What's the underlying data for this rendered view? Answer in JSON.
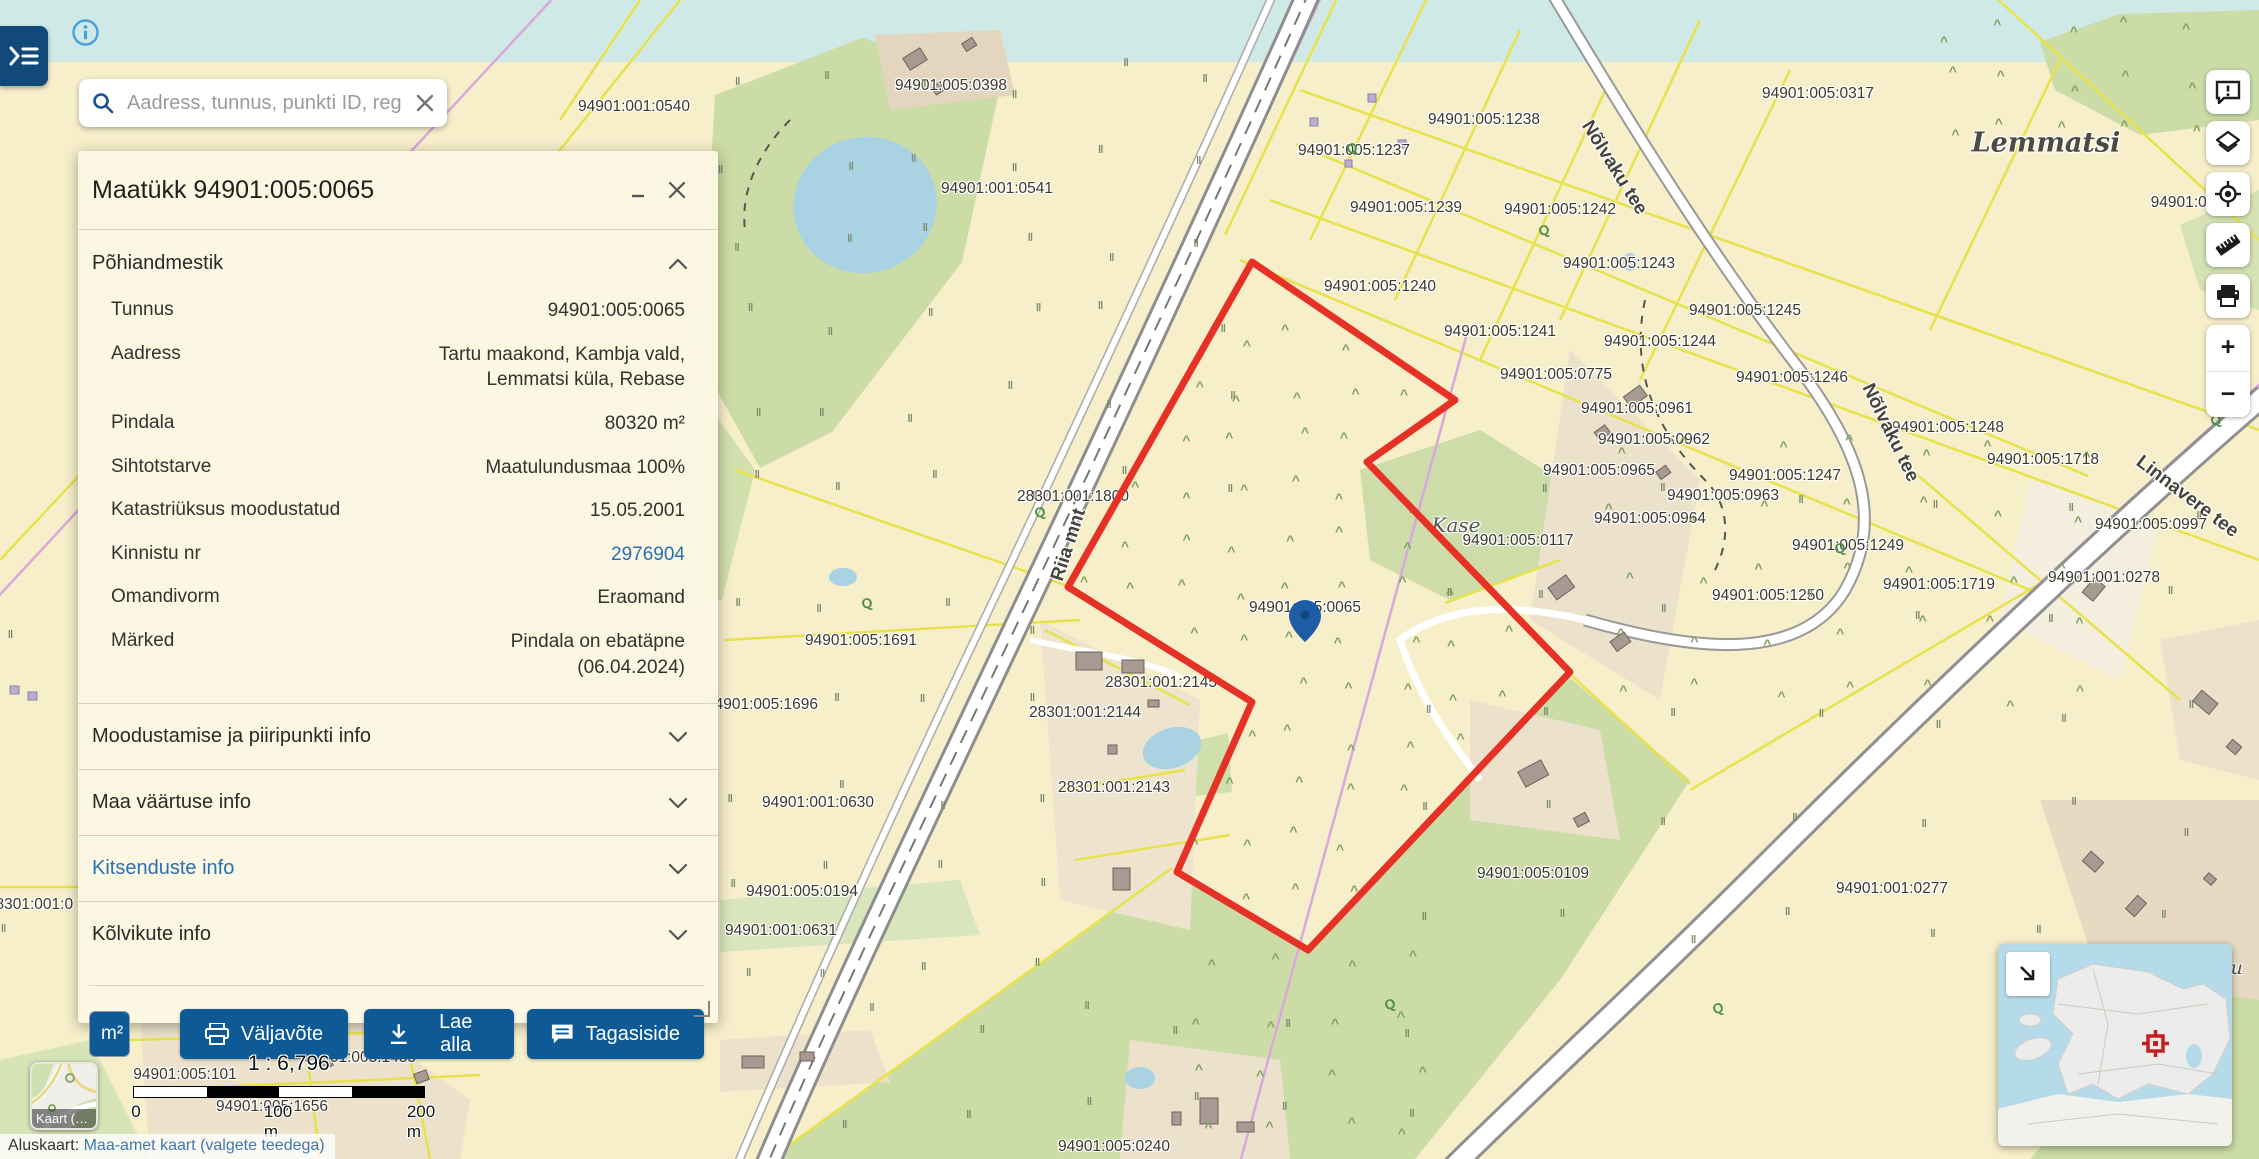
{
  "colors": {
    "accent_blue": "#0e5a96",
    "link_blue": "#2b6fb3",
    "selection_red": "#e63226",
    "map_base": "#f7efca",
    "top_water": "#cfe9e7"
  },
  "topbar": {
    "menu_icon": "sidebar-expand-icon",
    "info_icon": "info-icon"
  },
  "search": {
    "placeholder": "Aadress, tunnus, punkti ID, regi",
    "search_icon": "search-icon",
    "clear_icon": "close-icon"
  },
  "panel": {
    "title": "Maatükk 94901:005:0065",
    "minimize_icon": "minimize-icon",
    "close_icon": "close-icon",
    "section_main": "Põhiandmestik",
    "fields": [
      {
        "label": "Tunnus",
        "value": "94901:005:0065"
      },
      {
        "label": "Aadress",
        "value": "Tartu maakond, Kambja vald,",
        "value2": "Lemmatsi küla, Rebase"
      },
      {
        "label": "Pindala",
        "value": "80320 m²"
      },
      {
        "label": "Sihtotstarve",
        "value": "Maatulundusmaa 100%"
      },
      {
        "label": "Katastriüksus moodustatud",
        "value": "15.05.2001"
      },
      {
        "label": "Kinnistu nr",
        "value": "2976904"
      },
      {
        "label": "Omandivorm",
        "value": "Eraomand"
      },
      {
        "label": "Märked",
        "value": "Pindala on ebatäpne",
        "value2": "(06.04.2024)"
      }
    ],
    "accordions": [
      {
        "label": "Moodustamise ja piiripunkti info"
      },
      {
        "label": "Maa väärtuse info"
      },
      {
        "label": "Kitsenduste info",
        "blue": true
      },
      {
        "label": "Kõlvikute info"
      }
    ],
    "unit_toggle": {
      "m2": "m²",
      "ha": "ha"
    },
    "buttons": [
      {
        "label": "Väljavõte",
        "icon": "printer-icon"
      },
      {
        "label": "Lae alla",
        "icon": "download-icon"
      },
      {
        "label": "Tagasiside",
        "icon": "feedback-icon"
      }
    ]
  },
  "toolbar": {
    "items": [
      "feedback",
      "layers",
      "locate",
      "measure",
      "print"
    ],
    "zoom_in": "+",
    "zoom_out": "−"
  },
  "scale": {
    "ratio": "1 : 6,796",
    "ticks": [
      "0",
      "100 m",
      "200 m"
    ]
  },
  "basemap_button": {
    "label": "Kaart (…"
  },
  "attribution": {
    "prefix": "Aluskaart:",
    "link": "Maa-amet kaart (valgete teedega)"
  },
  "map": {
    "pin": {
      "x": 1305,
      "y": 648
    },
    "selected_parcel_points": [
      [
        1252,
        262
      ],
      [
        1455,
        400
      ],
      [
        1367,
        462
      ],
      [
        1570,
        672
      ],
      [
        1308,
        950
      ],
      [
        1177,
        872
      ],
      [
        1252,
        702
      ],
      [
        1068,
        587
      ]
    ],
    "labels": [
      {
        "text": "94901:001:0540",
        "x": 634,
        "y": 107
      },
      {
        "text": "94901:005:0398",
        "x": 951,
        "y": 86
      },
      {
        "text": "94901:005:1237",
        "x": 1354,
        "y": 151
      },
      {
        "text": "94901:005:1238",
        "x": 1484,
        "y": 120
      },
      {
        "text": "94901:005:0317",
        "x": 1818,
        "y": 94
      },
      {
        "text": "Lemmatsi",
        "x": 2046,
        "y": 143,
        "type": "place-lg"
      },
      {
        "text": "94901:001:0541",
        "x": 997,
        "y": 189
      },
      {
        "text": "94901:005:1239",
        "x": 1406,
        "y": 208
      },
      {
        "text": "94901:005:1242",
        "x": 1560,
        "y": 210
      },
      {
        "text": "Nõlvaku tee",
        "x": 1614,
        "y": 168,
        "type": "road",
        "rot": 58
      },
      {
        "text": "94901:005:1243",
        "x": 1619,
        "y": 264
      },
      {
        "text": "94901:005:1240",
        "x": 1380,
        "y": 287
      },
      {
        "text": "94901:005:1245",
        "x": 1745,
        "y": 311
      },
      {
        "text": "94901:005:1241",
        "x": 1500,
        "y": 332
      },
      {
        "text": "94901:005:1244",
        "x": 1660,
        "y": 342
      },
      {
        "text": "94901:005:1246",
        "x": 1792,
        "y": 378
      },
      {
        "text": "94901:005:0775",
        "x": 1556,
        "y": 375
      },
      {
        "text": "94901:005:0961",
        "x": 1637,
        "y": 409
      },
      {
        "text": "94901:00",
        "x": 2183,
        "y": 203
      },
      {
        "text": "94901:005:1248",
        "x": 1948,
        "y": 428
      },
      {
        "text": "94901:005:0962",
        "x": 1654,
        "y": 440
      },
      {
        "text": "94901:005:1718",
        "x": 2043,
        "y": 460
      },
      {
        "text": "Linnavere tee",
        "x": 2187,
        "y": 497,
        "type": "road",
        "rot": 37
      },
      {
        "text": "94901:005:0965",
        "x": 1599,
        "y": 471
      },
      {
        "text": "94901:005:1247",
        "x": 1785,
        "y": 476
      },
      {
        "text": "Nõlvaku tee",
        "x": 1890,
        "y": 433,
        "type": "road",
        "rot": 64
      },
      {
        "text": "94901:005:0963",
        "x": 1723,
        "y": 496
      },
      {
        "text": "Kase",
        "x": 1456,
        "y": 525,
        "type": "place-sm"
      },
      {
        "text": "94901:005:0964",
        "x": 1650,
        "y": 519
      },
      {
        "text": "94901:005:0117",
        "x": 1518,
        "y": 541
      },
      {
        "text": "94901:005:1249",
        "x": 1848,
        "y": 546
      },
      {
        "text": "94901:005:0997",
        "x": 2151,
        "y": 525
      },
      {
        "text": "94901:001:0278",
        "x": 2104,
        "y": 578
      },
      {
        "text": "94901:005:1719",
        "x": 1939,
        "y": 585
      },
      {
        "text": "94901:005:1250",
        "x": 1768,
        "y": 596
      },
      {
        "text": "94901:005:0065",
        "x": 1305,
        "y": 608
      },
      {
        "text": "28301:001:1800",
        "x": 1073,
        "y": 497
      },
      {
        "text": "Riia mnt",
        "x": 1069,
        "y": 545,
        "type": "road",
        "rot": -72
      },
      {
        "text": "94901:005:1691",
        "x": 861,
        "y": 641
      },
      {
        "text": "94901:005:1696",
        "x": 762,
        "y": 705
      },
      {
        "text": "28301:001:2145",
        "x": 1161,
        "y": 683
      },
      {
        "text": "28301:001:2144",
        "x": 1085,
        "y": 713
      },
      {
        "text": "28301:001:2143",
        "x": 1114,
        "y": 788
      },
      {
        "text": "94901:001:0630",
        "x": 818,
        "y": 803
      },
      {
        "text": "94901:005:0194",
        "x": 802,
        "y": 892
      },
      {
        "text": "94901:001:0631",
        "x": 781,
        "y": 931
      },
      {
        "text": "28301:001:0",
        "x": 30,
        "y": 905
      },
      {
        "text": "94901:005:0109",
        "x": 1533,
        "y": 874
      },
      {
        "text": "94901:001:0277",
        "x": 1892,
        "y": 889
      },
      {
        "text": "iku",
        "x": 2228,
        "y": 968,
        "type": "italic"
      },
      {
        "text": "94901:005:1655",
        "x": 274,
        "y": 1024
      },
      {
        "text": "94901:005:1486",
        "x": 446,
        "y": 1024
      },
      {
        "text": "94901:005:1485",
        "x": 360,
        "y": 1058
      },
      {
        "text": "94901:005:101",
        "x": 185,
        "y": 1075
      },
      {
        "text": "94901:005:1656",
        "x": 272,
        "y": 1107
      },
      {
        "text": "94901:005:0240",
        "x": 1114,
        "y": 1147
      }
    ]
  }
}
